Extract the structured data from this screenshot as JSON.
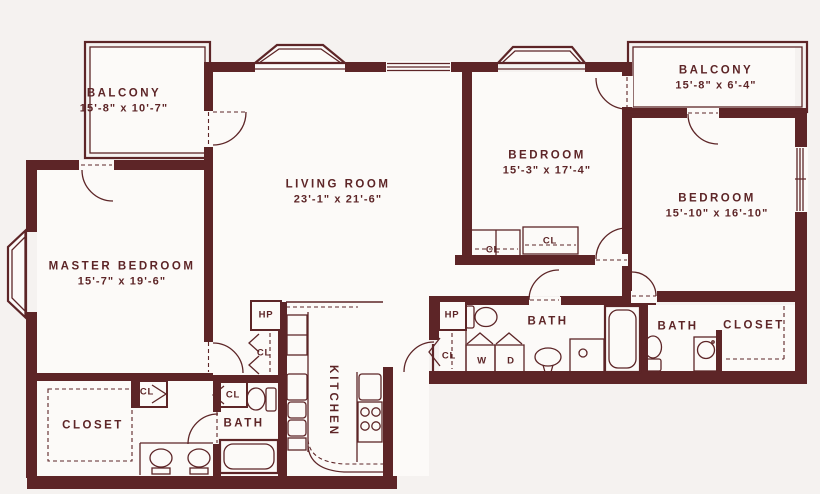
{
  "palette": {
    "wall": "#5d2527",
    "background": "#f5f2f0",
    "room_fill": "#fcfaf8"
  },
  "rooms": [
    {
      "id": "balcony-left",
      "label": "BALCONY",
      "dims": "15'-8\" x 10'-7\""
    },
    {
      "id": "balcony-right",
      "label": "BALCONY",
      "dims": "15'-8\" x 6'-4\""
    },
    {
      "id": "living-room",
      "label": "LIVING ROOM",
      "dims": "23'-1\" x 21'-6\""
    },
    {
      "id": "bedroom-middle",
      "label": "BEDROOM",
      "dims": "15'-3\" x 17'-4\""
    },
    {
      "id": "bedroom-right",
      "label": "BEDROOM",
      "dims": "15'-10\" x 16'-10\""
    },
    {
      "id": "master-bedroom",
      "label": "MASTER BEDROOM",
      "dims": "15'-7\" x 19'-6\""
    },
    {
      "id": "closet-left",
      "label": "CLOSET",
      "dims": ""
    },
    {
      "id": "bath-left",
      "label": "BATH",
      "dims": ""
    },
    {
      "id": "kitchen",
      "label": "KITCHEN",
      "dims": ""
    },
    {
      "id": "bath-middle",
      "label": "BATH",
      "dims": ""
    },
    {
      "id": "bath-right",
      "label": "BATH",
      "dims": ""
    },
    {
      "id": "closet-right",
      "label": "CLOSET",
      "dims": ""
    }
  ],
  "small_labels": [
    {
      "id": "cl-corridor-cell-1",
      "text": "CL"
    },
    {
      "id": "cl-corridor-cell-2",
      "text": "CL"
    },
    {
      "id": "cl-hall-kitchen",
      "text": "CL"
    },
    {
      "id": "hp-hall-kitchen",
      "text": "HP"
    },
    {
      "id": "hp-bath-middle",
      "text": "HP"
    },
    {
      "id": "cl-bath-middle",
      "text": "CL"
    },
    {
      "id": "cl-bedroom-closet-l",
      "text": "CL"
    },
    {
      "id": "cl-bedroom-closet-r",
      "text": "CL"
    },
    {
      "id": "washer",
      "text": "W"
    },
    {
      "id": "dryer",
      "text": "D"
    }
  ]
}
